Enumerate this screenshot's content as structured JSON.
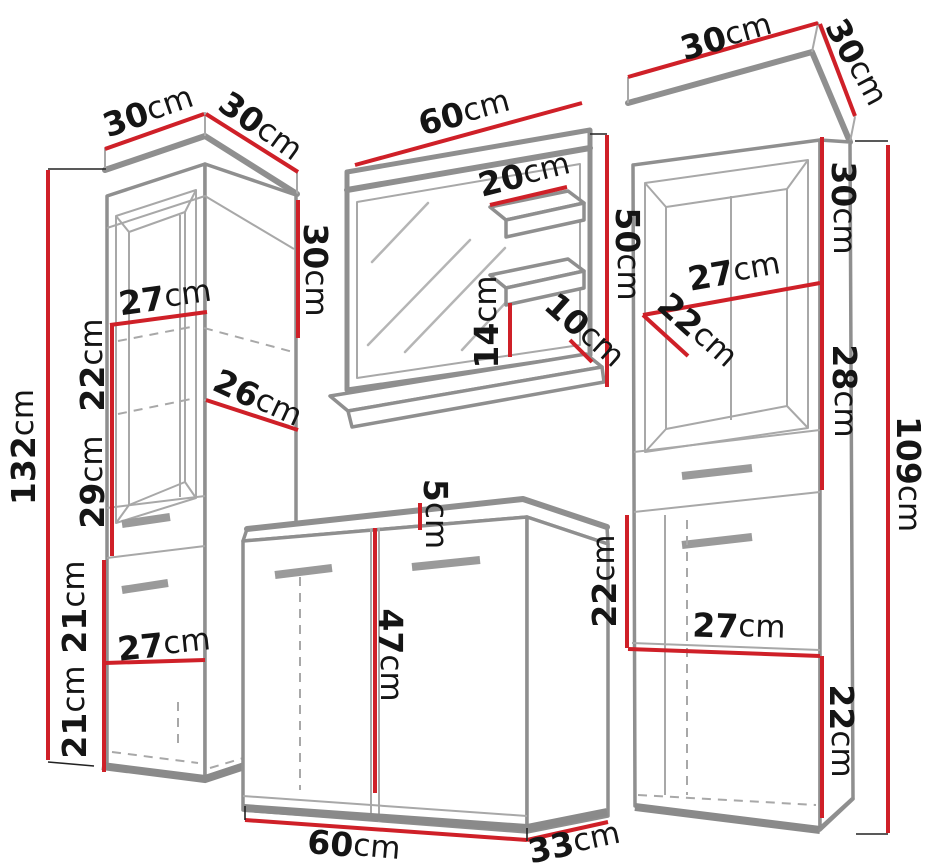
{
  "diagram": {
    "type": "furniture-dimension-diagram",
    "subject": "bathroom furniture set with dimension callouts",
    "unit": "cm",
    "colors": {
      "dimension_line_red": "#cf2028",
      "outline_gray": "#8f8f8f",
      "outline_light_gray": "#a8a8a8",
      "text_ink": "#151515",
      "background": "#ffffff"
    },
    "items": [
      {
        "id": "left-tall-cabinet",
        "dimensions": [
          {
            "value": "30",
            "unit": "cm",
            "edge": "top-width",
            "x": 148,
            "y": 111,
            "rotate": -19
          },
          {
            "value": "30",
            "unit": "cm",
            "edge": "top-depth",
            "x": 261,
            "y": 126,
            "rotate": 36
          },
          {
            "value": "30",
            "unit": "cm",
            "edge": "upper-side-height",
            "x": 316,
            "y": 270,
            "rotate": 90
          },
          {
            "value": "27",
            "unit": "cm",
            "edge": "inner-width-upper",
            "x": 165,
            "y": 297,
            "rotate": -8
          },
          {
            "value": "22",
            "unit": "cm",
            "edge": "shelf-gap-upper",
            "x": 92,
            "y": 365,
            "rotate": -90
          },
          {
            "value": "26",
            "unit": "cm",
            "edge": "shelf-depth",
            "x": 258,
            "y": 398,
            "rotate": 25
          },
          {
            "value": "132",
            "unit": "cm",
            "edge": "total-height",
            "x": 23,
            "y": 447,
            "rotate": -90
          },
          {
            "value": "29",
            "unit": "cm",
            "edge": "shelf-gap-lower",
            "x": 92,
            "y": 482,
            "rotate": -90
          },
          {
            "value": "21",
            "unit": "cm",
            "edge": "drawer-section-height",
            "x": 74,
            "y": 607,
            "rotate": -90
          },
          {
            "value": "27",
            "unit": "cm",
            "edge": "inner-width-lower",
            "x": 164,
            "y": 644,
            "rotate": -6
          },
          {
            "value": "21",
            "unit": "cm",
            "edge": "bottom-section-height",
            "x": 74,
            "y": 712,
            "rotate": -90
          }
        ]
      },
      {
        "id": "mirror-with-shelves",
        "dimensions": [
          {
            "value": "60",
            "unit": "cm",
            "edge": "mirror-width",
            "x": 464,
            "y": 112,
            "rotate": -15
          },
          {
            "value": "20",
            "unit": "cm",
            "edge": "shelf-width",
            "x": 524,
            "y": 174,
            "rotate": -14
          },
          {
            "value": "50",
            "unit": "cm",
            "edge": "mirror-height",
            "x": 628,
            "y": 254,
            "rotate": 90
          },
          {
            "value": "14",
            "unit": "cm",
            "edge": "shelf-gap",
            "x": 486,
            "y": 322,
            "rotate": -90
          },
          {
            "value": "10",
            "unit": "cm",
            "edge": "shelf-depth",
            "x": 585,
            "y": 330,
            "rotate": 42
          }
        ]
      },
      {
        "id": "sink-cabinet",
        "dimensions": [
          {
            "value": "5",
            "unit": "cm",
            "edge": "counter-thickness",
            "x": 436,
            "y": 514,
            "rotate": 90
          },
          {
            "value": "47",
            "unit": "cm",
            "edge": "door-height",
            "x": 391,
            "y": 655,
            "rotate": 90
          },
          {
            "value": "60",
            "unit": "cm",
            "edge": "width",
            "x": 354,
            "y": 845,
            "rotate": 5
          },
          {
            "value": "33",
            "unit": "cm",
            "edge": "depth",
            "x": 574,
            "y": 842,
            "rotate": -12
          }
        ]
      },
      {
        "id": "right-tall-cabinet",
        "dimensions": [
          {
            "value": "30",
            "unit": "cm",
            "edge": "top-width",
            "x": 726,
            "y": 36,
            "rotate": -16
          },
          {
            "value": "30",
            "unit": "cm",
            "edge": "top-depth",
            "x": 857,
            "y": 62,
            "rotate": 62
          },
          {
            "value": "30",
            "unit": "cm",
            "edge": "upper-side-height",
            "x": 844,
            "y": 208,
            "rotate": 90
          },
          {
            "value": "27",
            "unit": "cm",
            "edge": "inner-width-upper",
            "x": 734,
            "y": 271,
            "rotate": -10
          },
          {
            "value": "22",
            "unit": "cm",
            "edge": "shelf-diagonal",
            "x": 698,
            "y": 330,
            "rotate": 42
          },
          {
            "value": "28",
            "unit": "cm",
            "edge": "middle-side-height",
            "x": 845,
            "y": 391,
            "rotate": 90
          },
          {
            "value": "109",
            "unit": "cm",
            "edge": "total-height",
            "x": 909,
            "y": 474,
            "rotate": 90
          },
          {
            "value": "22",
            "unit": "cm",
            "edge": "door-section-height",
            "x": 604,
            "y": 581,
            "rotate": -90
          },
          {
            "value": "27",
            "unit": "cm",
            "edge": "inner-width-lower",
            "x": 739,
            "y": 626,
            "rotate": 2
          },
          {
            "value": "22",
            "unit": "cm",
            "edge": "bottom-section-height",
            "x": 842,
            "y": 731,
            "rotate": 90
          }
        ]
      }
    ]
  }
}
